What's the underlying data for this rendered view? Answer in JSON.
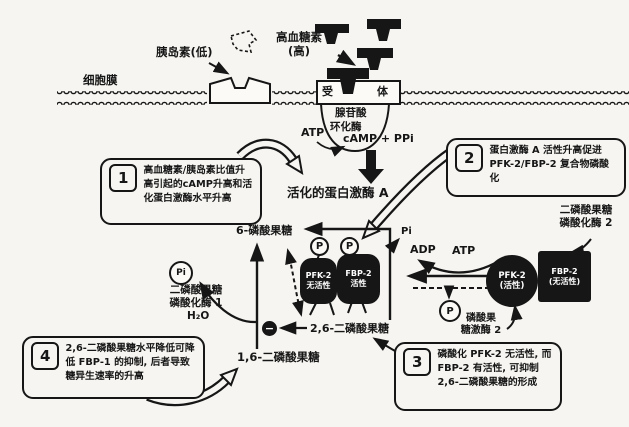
{
  "colors": {
    "ink": "#161616",
    "paper": "#f6f5f1"
  },
  "labels": {
    "membrane": "细胞膜",
    "insulin": "胰岛素(低)",
    "glucagon_line1": "高血糖素",
    "glucagon_line2": "(高)",
    "receptor_left": "受",
    "receptor_right": "体",
    "cyclase_line1": "腺苷酸",
    "cyclase_line2": "环化酶",
    "atp": "ATP",
    "camp_ppi": "cAMP + PPi",
    "pka": "活化的蛋白激酶 A",
    "f6p": "6-磷酸果糖",
    "pi_branch": "Pi",
    "f26bp": "2,6-二磷酸果糖",
    "f16bp": "1,6-二磷酸果糖",
    "h2o": "H₂O",
    "adp": "ADP",
    "atp2": "ATP",
    "p_tag": "P",
    "pi_released": "Pi",
    "p_released": "P",
    "minus": "−"
  },
  "enzymes": {
    "fbpase1_line1": "二磷酸果糖",
    "fbpase1_line2": "磷酸化酶 1",
    "fbpase2_line1": "二磷酸果糖",
    "fbpase2_line2": "磷酸化酶 2",
    "pfk2_line1": "磷酸果",
    "pfk2_line2": "糖激酶 2"
  },
  "complexes": {
    "mid_pfk2_name": "PFK-2",
    "mid_pfk2_state": "无活性",
    "mid_fbp2_name": "FBP-2",
    "mid_fbp2_state": "活性",
    "right_pfk2_name": "PFK-2",
    "right_pfk2_state": "(活性)",
    "right_fbp2_name": "FBP-2",
    "right_fbp2_state": "(无活性)"
  },
  "callouts": [
    {
      "num": "1",
      "text": "高血糖素/胰岛素比值升高引起的cAMP升高和活化蛋白激酶水平升高"
    },
    {
      "num": "2",
      "text": "蛋白激酶 A 活性升高促进 PFK-2/FBP-2 复合物磷酸化"
    },
    {
      "num": "3",
      "text": "磷酸化 PFK-2 无活性, 而 FBP-2 有活性, 可抑制 2,6-二磷酸果糖的形成"
    },
    {
      "num": "4",
      "text": "2,6-二磷酸果糖水平降低可降低 FBP-1 的抑制, 后者导致糖异生速率的升高"
    }
  ]
}
